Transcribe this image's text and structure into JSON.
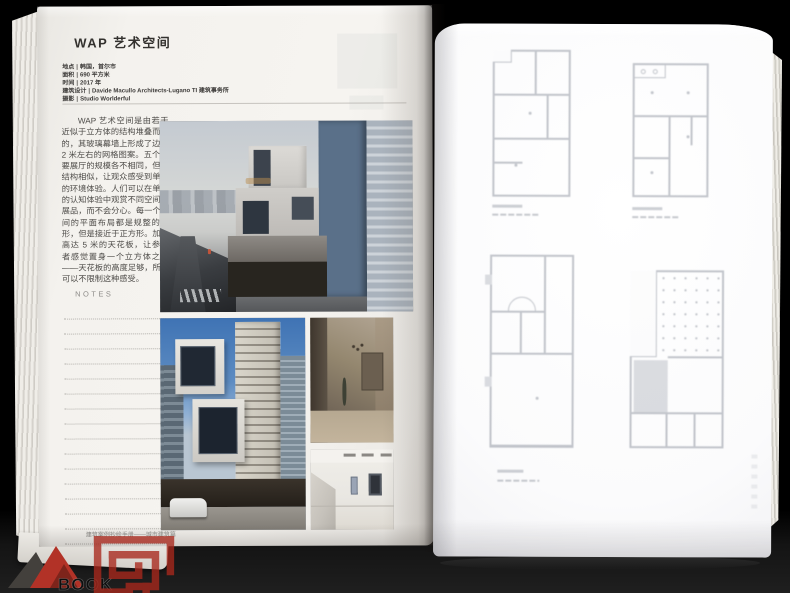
{
  "scene": {
    "background_color": "#000000",
    "table_color": "#1f1f1f",
    "description_left_page_color": "#f4f2ee",
    "description_right_page_color": "#fbfbfc"
  },
  "left_page": {
    "title": "WAP 艺术空间",
    "info_separator": "|",
    "info_lines": [
      {
        "label": "地点",
        "value": "韩国，首尔市"
      },
      {
        "label": "面积",
        "value": "690 平方米"
      },
      {
        "label": "时间",
        "value": "2017 年"
      },
      {
        "label": "建筑设计",
        "value": "Davide Macullo Architects-Lugano TI 建筑事务所"
      },
      {
        "label": "摄影",
        "value": "Studio Worlderful"
      }
    ],
    "body_text": "WAP 艺术空间是由若干近似于立方体的结构堆叠而成的，其玻璃幕墙上形成了边长 2 米左右的网格图案。五个主要展厅的规模各不相同，但是结构相似，让观众感受到单一的环境体验。人们可以在单一的认知体验中观赏不同空间的展品，而不会分心。每一个房间的平面布局都是规整的矩形，但是接近于正方形。加上高达 5 米的天花板，让参观者感觉置身一个立方体之中——天花板的高度足够，所以可以不限制这种感受。",
    "notes_label": "NOTES",
    "notes_line_count": 16,
    "footer": "建筑案例抄绘手册——城市建筑篇"
  },
  "right_page": {
    "content": "四张透过硫酸纸隐约可见的灰色楼层平面图",
    "plan_count": 4
  },
  "watermark": {
    "logo_text": "BOOK",
    "logo_red": "#b23227",
    "seal_red": "#a8281d"
  }
}
